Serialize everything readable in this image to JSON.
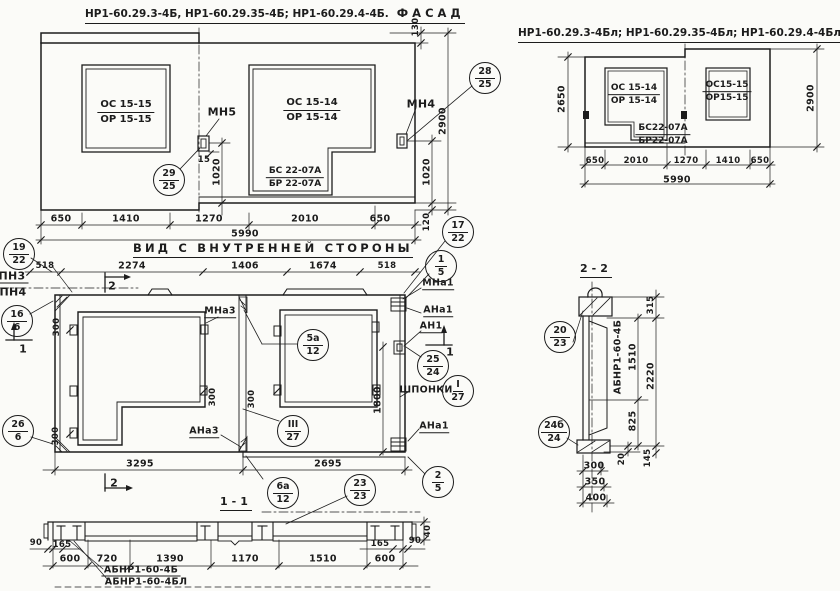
{
  "fl": {
    "title_ids": "НР1-60.29.3-4Б, НР1-60.29.35-4Б; НР1-60.29.4-4Б.",
    "title_word": "ФАСАД",
    "win1_top": "ОС 15-15",
    "win1_bot": "ОР 15-15",
    "win2_top": "ОС 15-14",
    "win2_bot": "ОР 15-14",
    "sill_top": "БС 22-07А",
    "sill_bot": "БР 22-07А",
    "mn5": "МН5",
    "mn4": "МН4",
    "d15": "15",
    "d1020m": "1020",
    "db": [
      "650",
      "1410",
      "1270",
      "2010",
      "650"
    ],
    "dtotal": "5990",
    "d130": "130",
    "d2900": "2900",
    "d1020r": "1020",
    "d120": "120"
  },
  "fr": {
    "title_ids": "НР1-60.29.3-4Бл; НР1-60.29.35-4Бл; НР1-60.29.4-4Бл",
    "title_word": "ФАСАД",
    "win1_top": "ОС 15-14",
    "win1_bot": "ОР 15-14",
    "win2_top": "ОС15-15",
    "win2_bot": "ОР15-15",
    "sill_top": "БС22-07А",
    "sill_bot": "БР22-07А",
    "db": [
      "650",
      "2010",
      "1270",
      "1410",
      "650"
    ],
    "dtotal": "5990",
    "d2650": "2650",
    "d2900": "2900"
  },
  "mv": {
    "title": "ВИД С ВНУТРЕННЕЙ СТОРОНЫ",
    "dt": [
      "518",
      "2274",
      "1406",
      "1674",
      "518"
    ],
    "db": [
      "3295",
      "2695"
    ],
    "d1800": "1800",
    "d300": "300",
    "pn3": "ПН3",
    "pn4": "ПН4",
    "mna3": "МНа3",
    "mna1": "МНа1",
    "ana1": "АНа1",
    "an1": "АН1",
    "ana3": "АНа3",
    "ana1b": "АНа1",
    "shponki": "ШПОНКИ",
    "mark1": "1",
    "mark2": "2"
  },
  "s11": {
    "title": "1-1",
    "d90l": "90",
    "d165l": "165",
    "d90r": "90",
    "d165r": "165",
    "d40": "40",
    "db": [
      "600",
      "720",
      "1390",
      "1170",
      "1510",
      "600"
    ],
    "lbl1": "АБНР1-60-4Б",
    "lbl2": "АБНР1-60-4БЛ"
  },
  "s22": {
    "title": "2-2",
    "member": "АБНР1-60-4Б",
    "d315": "315",
    "d1510": "1510",
    "d2220": "2220",
    "d825": "825",
    "d20": "20",
    "d145": "145",
    "d300": "300",
    "d350": "350",
    "d400": "400"
  },
  "co": {
    "c29_25": {
      "t": "29",
      "b": "25"
    },
    "c28_25": {
      "t": "28",
      "b": "25"
    },
    "c17_22": {
      "t": "17",
      "b": "22"
    },
    "c1_5": {
      "t": "1",
      "b": "5"
    },
    "c19_22": {
      "t": "19",
      "b": "22"
    },
    "c16_6": {
      "t": "16",
      "b": "6"
    },
    "c26_6": {
      "t": "26",
      "b": "6"
    },
    "c5a_12": {
      "t": "5а",
      "b": "12"
    },
    "c25_24": {
      "t": "25",
      "b": "24"
    },
    "cI_27": {
      "t": "I",
      "b": "27"
    },
    "cIII_27": {
      "t": "III",
      "b": "27"
    },
    "c6a_12": {
      "t": "6а",
      "b": "12"
    },
    "c23_23": {
      "t": "23",
      "b": "23"
    },
    "c2_5": {
      "t": "2",
      "b": "5"
    },
    "c20_23": {
      "t": "20",
      "b": "23"
    },
    "c24b_24": {
      "t": "24б",
      "b": "24"
    }
  },
  "colors": {
    "ink": "#1c1c1c",
    "paper": "#fbfbf8"
  }
}
